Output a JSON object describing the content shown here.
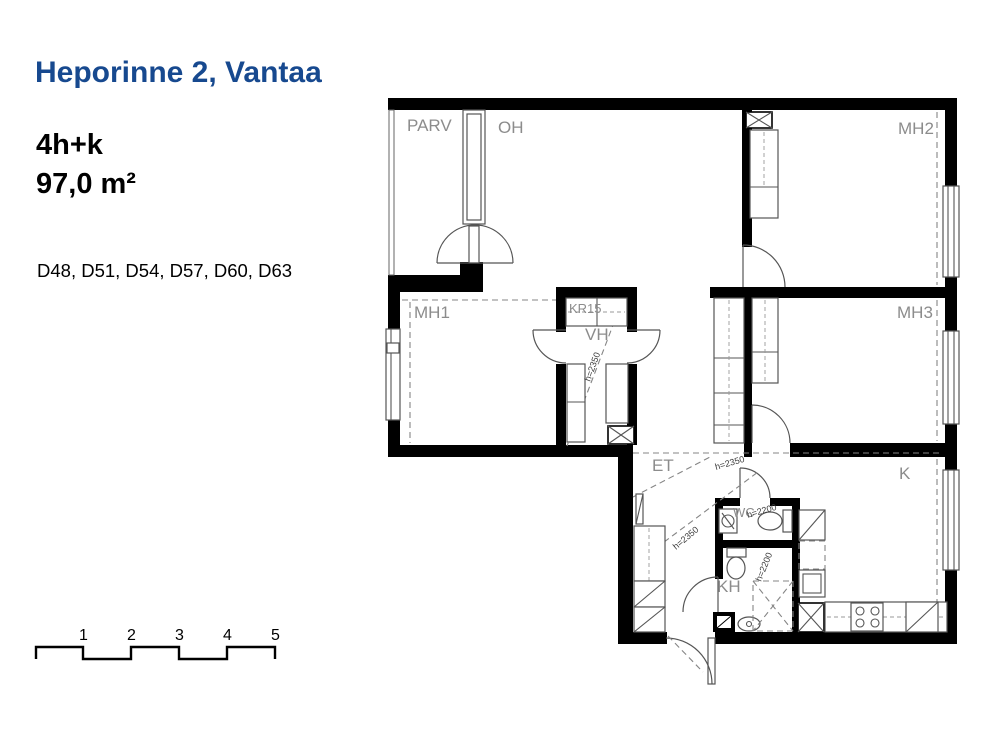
{
  "sidebar": {
    "title": "Heporinne 2, Vantaa",
    "apartment_type": "4h+k",
    "area": "97,0 m²",
    "apartment_numbers": "D48, D51, D54, D57, D60, D63"
  },
  "plan": {
    "rooms": {
      "parv": "PARV",
      "oh": "OH",
      "mh2": "MH2",
      "mh1": "MH1",
      "kr15": "KR15",
      "vh": "VH",
      "mh3": "MH3",
      "et": "ET",
      "k": "K",
      "wc": "WC",
      "kh": "KH"
    },
    "heights": {
      "h2350": "h=2350",
      "h2200": "h=2200"
    }
  },
  "scale": {
    "ticks": [
      "1",
      "2",
      "3",
      "4",
      "5"
    ]
  },
  "colors": {
    "title_blue": "#17498f",
    "wall_black": "#000000",
    "room_label_gray": "#8c8c8c"
  }
}
